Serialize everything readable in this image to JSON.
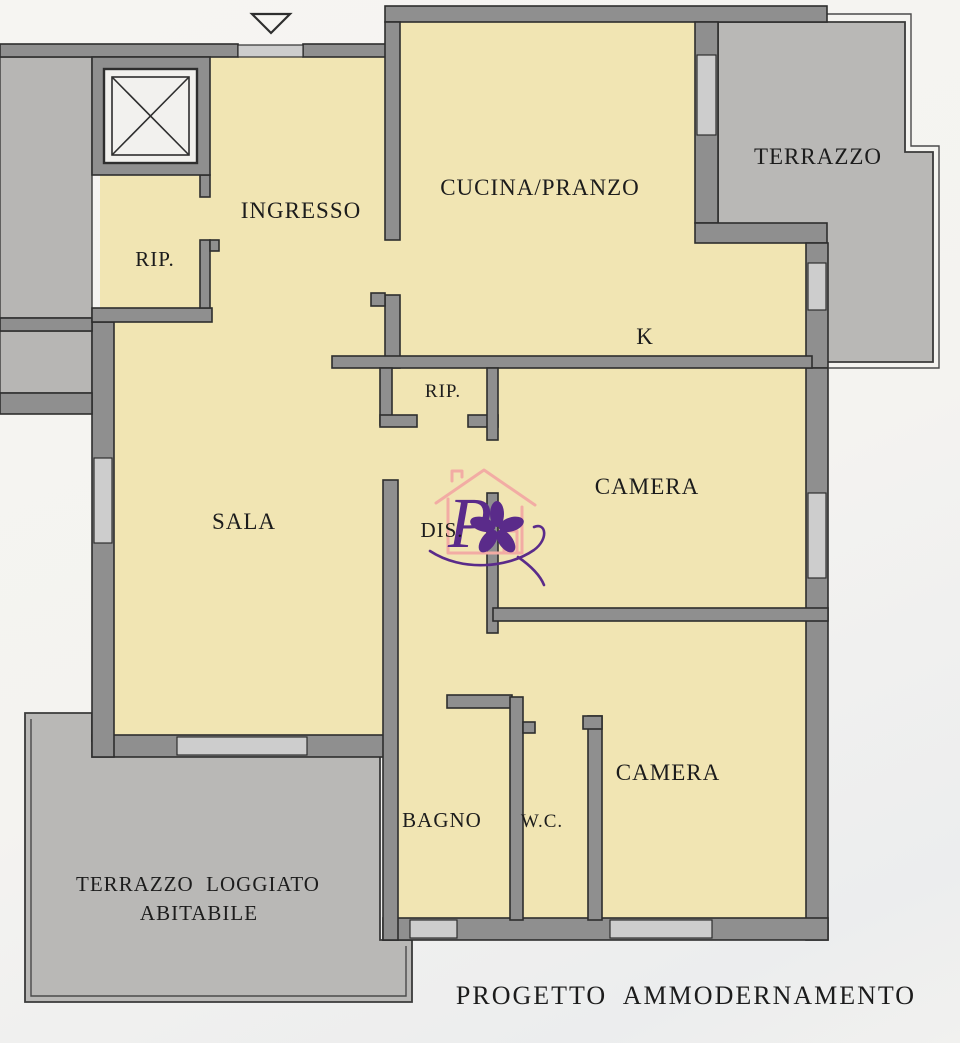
{
  "plan": {
    "rooms": {
      "ingresso": "INGRESSO",
      "rip_top": "RIP.",
      "cucina_pranzo": "CUCINA/PRANZO",
      "terrazzo": "TERRAZZO",
      "kitchen_k": "K",
      "rip_mid": "RIP.",
      "camera_mid": "CAMERA",
      "sala": "SALA",
      "disimpegno": "DIS.",
      "bagno": "BAGNO",
      "wc": "W.C.",
      "camera_bottom": "CAMERA",
      "terrazzo_loggiato_line1": "TERRAZZO  LOGGIATO",
      "terrazzo_loggiato_line2": "ABITABILE"
    },
    "footer_title": "PROGETTO  AMMODERNAMENTO",
    "colors": {
      "room_fill": "#f1e5b3",
      "wall_fill": "#8f8f8f",
      "wall_outline": "#2e2e2e",
      "terrace_fill": "#b9b8b6",
      "opening_fill": "#cdcdcd",
      "label_color": "#1c1c1c",
      "logo_purple": "#5a2b8a",
      "logo_pink": "#f2aca4",
      "paper": "#f4f3f0"
    }
  }
}
